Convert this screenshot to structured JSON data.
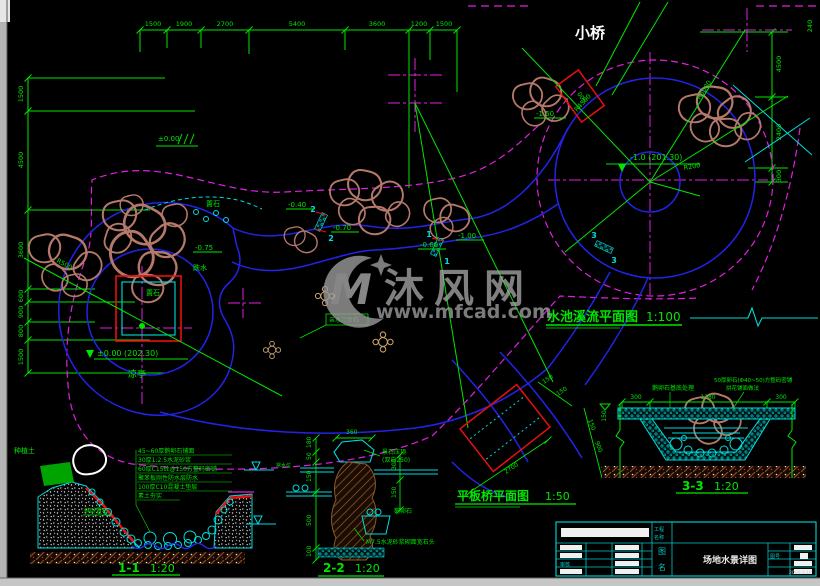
{
  "colors": {
    "green": "#00e600",
    "blue": "#2323e8",
    "cyan": "#00dcdc",
    "magenta": "#e020e0",
    "red": "#e81010",
    "rock": "#b5796a",
    "watermark": "#9a9a9a"
  },
  "watermark": {
    "logo": "M",
    "brand": "沐风网",
    "url": "www.mfcad.com"
  },
  "plan": {
    "title": "水池溪流平面图",
    "scale": "1:100",
    "bridge": "小桥",
    "bridge_dim": "900",
    "bridge_level": "-1.50",
    "pavilion": "凉亭",
    "pavilion_level": "±0.00 (202.30)",
    "pond_level": "-1.0 (201.30)",
    "datum": "±0.00",
    "rock1": "置石",
    "rock2": "置石",
    "waterfall": "跌水",
    "drop1": "-0.75",
    "steps_box": "亲水汀步石",
    "levels": [
      "-0.40",
      "-0.70",
      "-0.60",
      "-1.00"
    ],
    "radii": {
      "r1": "R4500",
      "r2": "R5000",
      "r3": "R200",
      "r4": "R500"
    },
    "cuts": {
      "c1": "1",
      "c2": "2",
      "c3": "3"
    },
    "dims_top": [
      "1500",
      "1900",
      "2700",
      "5400",
      "3600",
      "1200",
      "1500"
    ],
    "dims_left": [
      "1500",
      "4500",
      "3600",
      "600",
      "900",
      "800",
      "1500"
    ],
    "dims_right": [
      "240",
      "4500",
      "2400",
      "300"
    ]
  },
  "bridge_plan": {
    "title": "平板桥平面图",
    "scale": "1:50",
    "dim_span": "2700",
    "dim_a": "150",
    "dim_b": "150",
    "dim_w1": "150",
    "dim_w2": "900",
    "dim_w3": "150"
  },
  "s11": {
    "title": "1-1",
    "scale": "1:20",
    "notes": [
      "45~60厚鹅卵石铺面",
      "30厚1:2.5水泥砂浆",
      "60厚C15砼@150方整码密铺",
      "聚苯板刚性防水层防水",
      "100厚C10混凝土垫层",
      "素土夯实"
    ],
    "soil": "种植土",
    "cap": "斜卧置石",
    "water": "常水位"
  },
  "s22": {
    "title": "2-2",
    "scale": "1:20",
    "dim_top": "360",
    "dims_left": [
      "180",
      "50",
      "150",
      "500",
      "100"
    ],
    "dims_right": [
      "300",
      "150"
    ],
    "cap1": "景石压顶",
    "cap2": "(双向250)",
    "pebble": "鹅卵石",
    "mortar": "M7.5水泥砂浆砌面宽石头"
  },
  "s33": {
    "title": "3-3",
    "scale": "1:20",
    "dims_top": [
      "300",
      "1180",
      "300"
    ],
    "note_left": "鹅卵石基底处理",
    "note_r1": "50厚卵石(Φ40~50)方整码密铺",
    "note_r2": "拼花铺面做法",
    "dim_side": "150"
  },
  "titleblock": {
    "hdr1": "工程",
    "hdr2": "名称",
    "name_l1": "图",
    "name_l2": "名",
    "name": "场地水景详图",
    "no_label": "图号",
    "date": "2006.1.10",
    "audit": "审核"
  }
}
